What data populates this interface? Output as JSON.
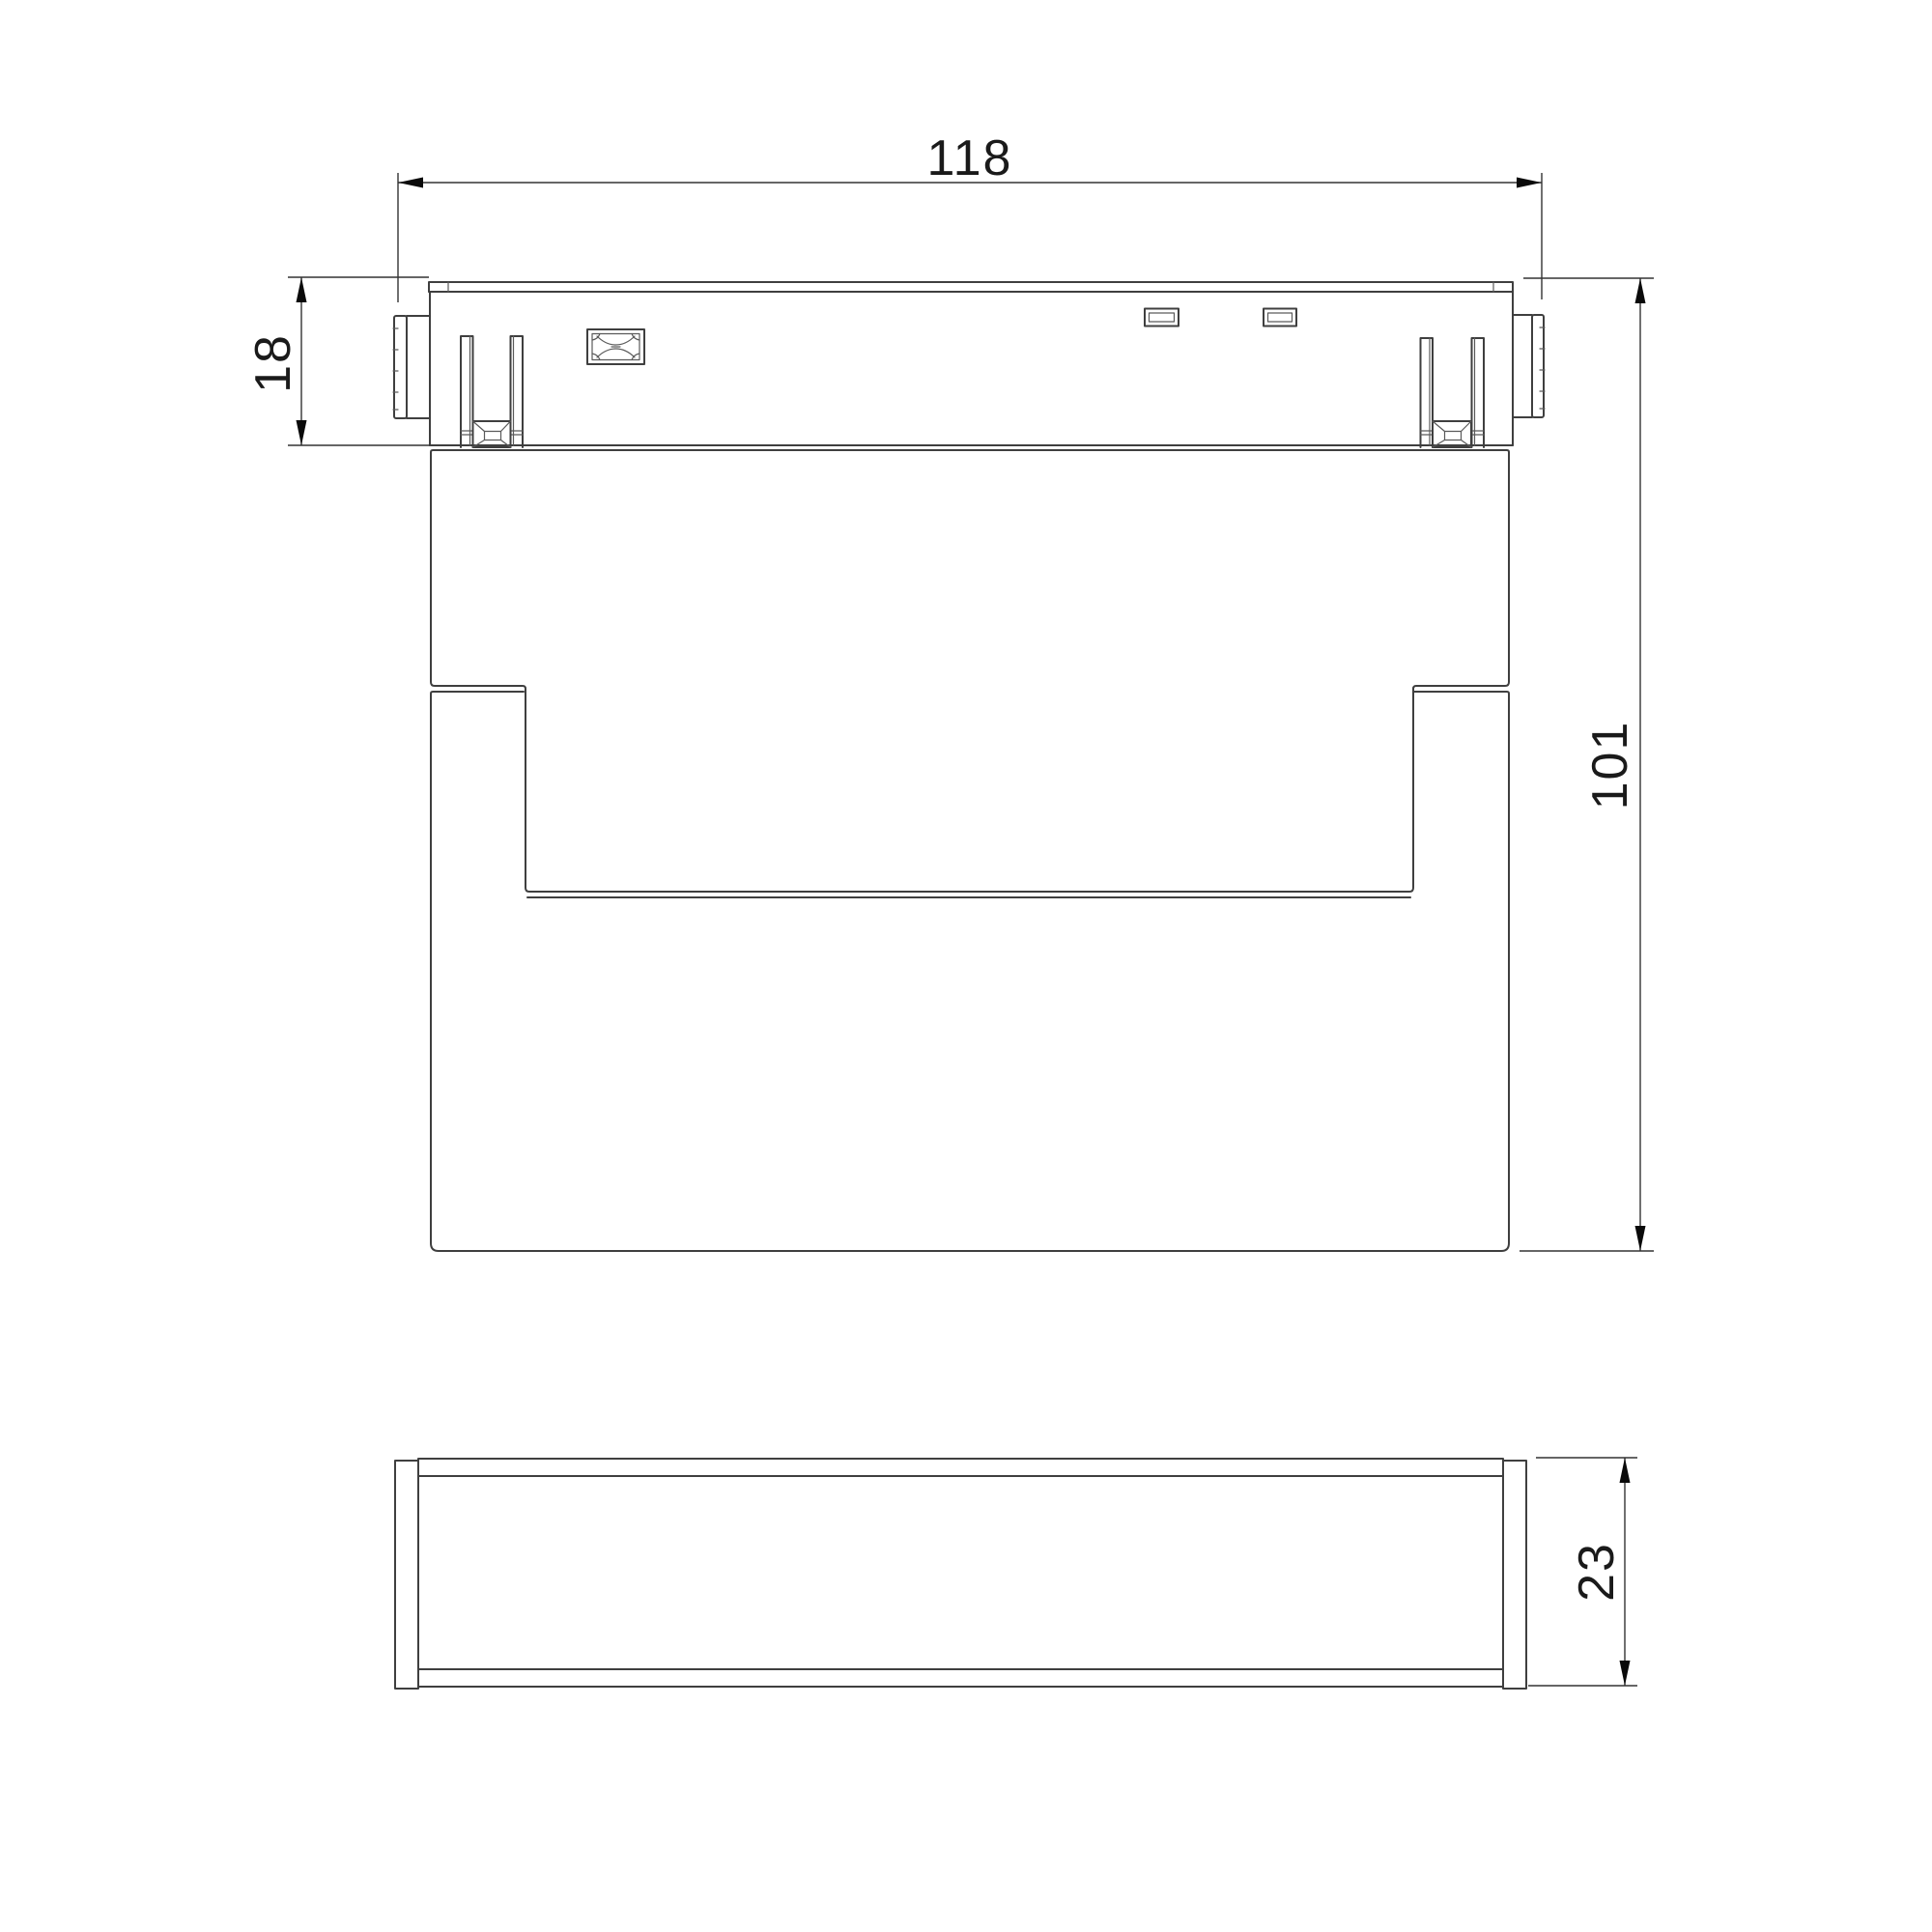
{
  "drawing": {
    "type": "technical-dimension-drawing",
    "units_shown": false,
    "colors": {
      "background": "#ffffff",
      "object_line": "#3f3f3f",
      "detail_line": "#5a5a5a",
      "dimension_line": "#343434",
      "text": "#1a1a1a"
    },
    "views": {
      "front_view": "track-light-front-elevation",
      "side_view": "track-light-side-profile"
    },
    "dimensions": {
      "overall_width": "118",
      "adapter_height": "18",
      "body_height": "101",
      "depth": "23"
    }
  }
}
